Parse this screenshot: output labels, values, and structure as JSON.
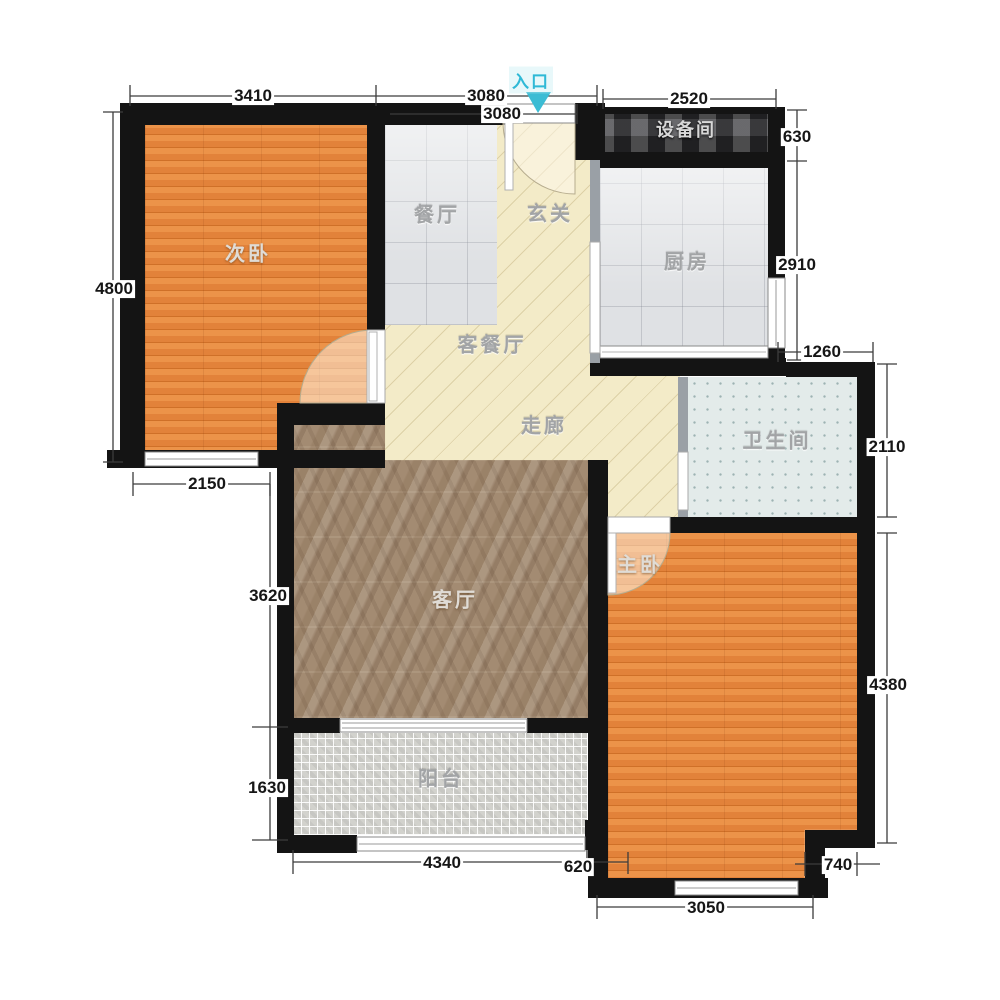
{
  "plan": {
    "entrance_label": "入口",
    "rooms": {
      "ciwo": "次卧",
      "canting": "餐厅",
      "xuanguan": "玄关",
      "shebeijian": "设备间",
      "chufang": "厨房",
      "weishengjian": "卫生间",
      "kecanting": "客餐厅",
      "zoulang": "走廊",
      "keting": "客厅",
      "zhuwo": "主卧",
      "yangtai": "阳台"
    },
    "dims": {
      "top_3410": "3410",
      "top_3080": "3080",
      "inner_3080": "3080",
      "top_2520": "2520",
      "r_630": "630",
      "r_2910": "2910",
      "r_1260": "1260",
      "r_2110": "2110",
      "r_4380": "4380",
      "r_740": "740",
      "l_4800": "4800",
      "l_2150": "2150",
      "l_3620": "3620",
      "l_1630": "1630",
      "b_4340": "4340",
      "b_620": "620",
      "b_3050": "3050"
    },
    "colors": {
      "wall": "#141414",
      "wood": "#e2863c",
      "tile": "#dfe1e4",
      "cream": "#f3ebc8",
      "marble": "#a38b72",
      "bath_tile": "#e3ebea",
      "balcony_tile": "#d2d2cd",
      "equipment": "#46464a",
      "entrance_accent": "#3bbcd4",
      "dim_line": "#3c3c3c"
    }
  }
}
